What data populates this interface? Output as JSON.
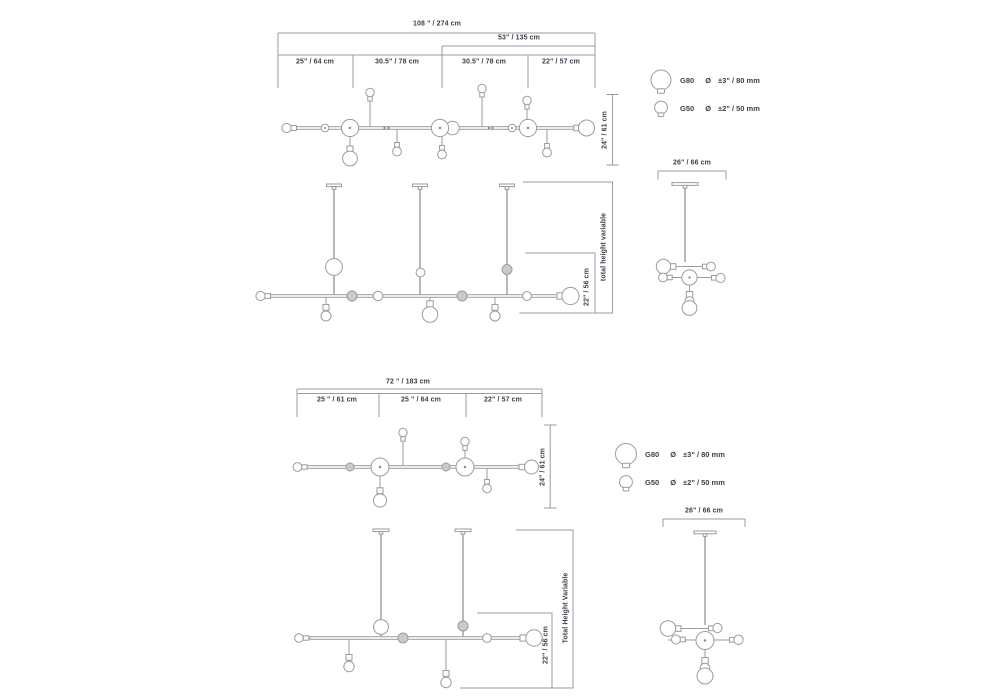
{
  "colors": {
    "line": "#9b9ba1",
    "text": "#3e3e49"
  },
  "set_a": {
    "dim_total": "108 \" / 274 cm",
    "dim_partial": "53\" / 135 cm",
    "segments": [
      "25\" / 64 cm",
      "30.5\" / 78 cm",
      "30.5\" / 78 cm",
      "22\" / 57 cm"
    ],
    "dim_depth": "24\" / 61 cm",
    "dim_side": "26\" / 66 cm",
    "dim_height": "total height variable",
    "dim_drop": "22\" / 56 cm"
  },
  "set_b": {
    "dim_total": "72 \" / 183 cm",
    "segments": [
      "25 \" / 61 cm",
      "25 \" / 64 cm",
      "22\" / 57 cm"
    ],
    "dim_depth": "24\" / 61 cm",
    "dim_side": "26\" / 66 cm",
    "dim_height": "Total Height Variable",
    "dim_drop": "22\" / 56 cm"
  },
  "legend": {
    "diameter_symbol": "Ø",
    "g80": {
      "label": "G80",
      "size": "±3\" / 80 mm"
    },
    "g50": {
      "label": "G50",
      "size": "±2\" / 50 mm"
    }
  }
}
